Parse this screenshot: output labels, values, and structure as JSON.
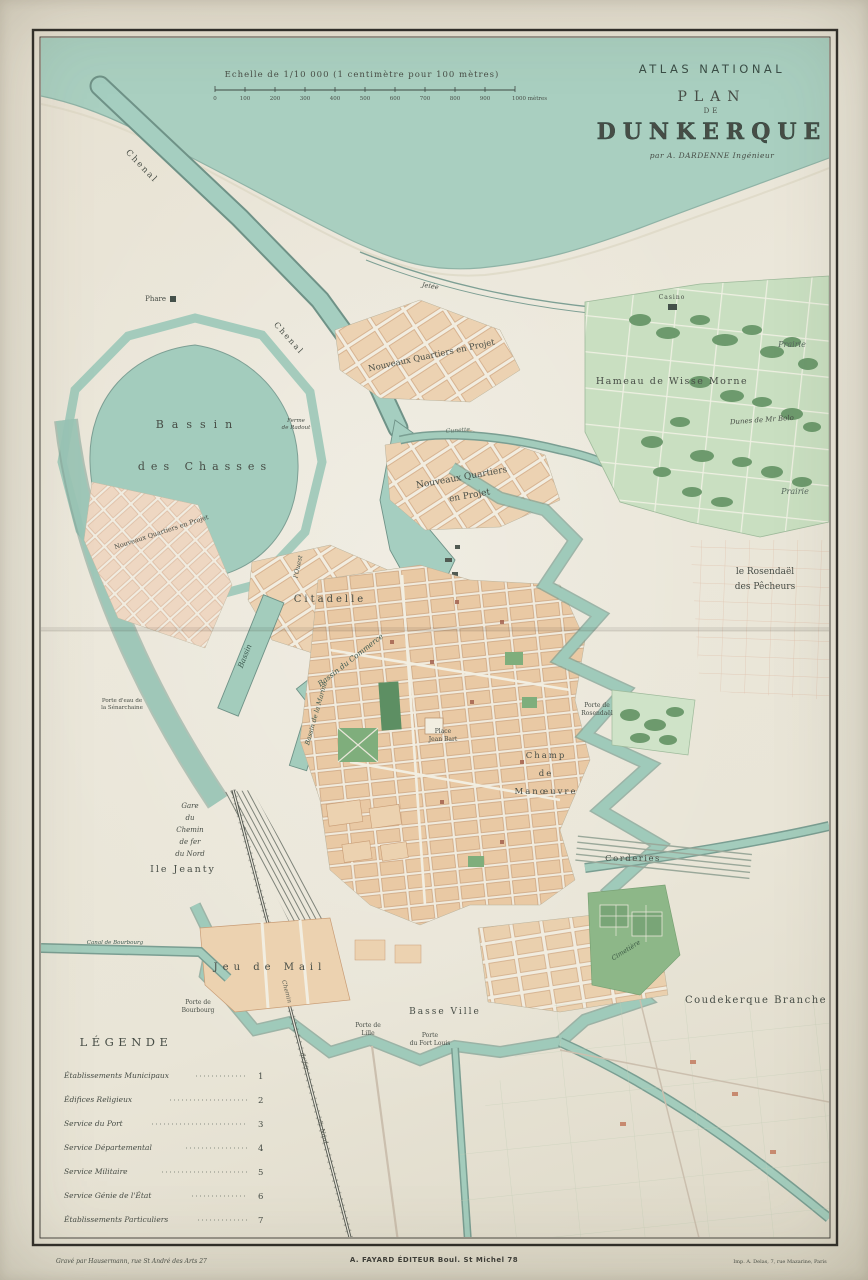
{
  "title": {
    "series": "ATLAS NATIONAL",
    "plan": "PLAN",
    "de": "DE",
    "city": "DUNKERQUE",
    "author": "par A. DARDENNE Ingénieur"
  },
  "scale": {
    "caption": "Echelle de 1/10 000 (1 centimètre pour 100 mètres)",
    "ticks": [
      "0",
      "100",
      "200",
      "300",
      "400",
      "500",
      "600",
      "700",
      "800",
      "900",
      "1000 mètres"
    ]
  },
  "legend": {
    "title": "LÉGENDE",
    "items": [
      {
        "label": "Établissements Municipaux",
        "num": "1"
      },
      {
        "label": "Édifices Religieux",
        "num": "2"
      },
      {
        "label": "Service du Port",
        "num": "3"
      },
      {
        "label": "Service Départemental",
        "num": "4"
      },
      {
        "label": "Service Militaire",
        "num": "5"
      },
      {
        "label": "Service Génie de l'État",
        "num": "6"
      },
      {
        "label": "Établissements Particuliers",
        "num": "7"
      }
    ]
  },
  "imprint": {
    "left": "Gravé par Hausermann, rue St André des Arts 27",
    "center": "A. FAYARD ÉDITEUR  Boul. St Michel 78",
    "right": "Imp. A. Delas, 7, rue Mazarine, Paris"
  },
  "labels": {
    "chenal_a": "Chenal",
    "chenal_b": "Chenal",
    "phare": "Phare",
    "jetee": "Jetée",
    "bassin1": "Bassin",
    "bassin2": "des Chasses",
    "ferme1": "Ferme",
    "ferme2": "de Radout",
    "nq1": "Nouveaux Quartiers en Projet",
    "nq2a": "Nouveaux Quartiers",
    "nq2b": "en Projet",
    "nq3": "Nouveaux Quartiers en Projet",
    "cunette": "Cunette",
    "hameau": "Hameau de Wisse Morne",
    "casino": "Casino",
    "prairie1": "Prairie",
    "prairie2": "Prairie",
    "dunes_prop": "Dunes de Mr Bolo",
    "rosendael1": "le Rosendaël",
    "rosendael2": "des Pêcheurs",
    "citadelle": "Citadelle",
    "bassin_commerce": "Bassin du Commerce",
    "bassin_ouest": "Bassin",
    "louest": "l'Ouest",
    "bassin_marine": "Bassin de la Marine",
    "porte_eau1": "Porte d'eau de",
    "porte_eau2": "la Sénarchaine",
    "place1": "Place",
    "place2": "Jean Bart",
    "champ1": "Champ",
    "champ2": "de",
    "champ3": "Manœuvre",
    "porte_ros1": "Porte de",
    "porte_ros2": "Rosendaël",
    "gare1": "Gare",
    "gare2": "du",
    "gare3": "Chemin",
    "gare4": "de fer",
    "gare5": "du Nord",
    "ile_jeanty": "Ile Jeanty",
    "jeu_de_mail": "Jeu de Mail",
    "porte_bourbourg1": "Porte de",
    "porte_bourbourg2": "Bourbourg",
    "basse_ville": "Basse Ville",
    "porte_lille1": "Porte de",
    "porte_lille2": "Lille",
    "porte_fl1": "Porte",
    "porte_fl2": "du Fort Louis",
    "corderies": "Corderies",
    "cimetiere": "Cimetière",
    "coudekerque": "Coudekerque Branche",
    "rail1": "Chemin",
    "rail2": "de fer",
    "rail3": "du Nord",
    "canal_bourbourg": "Canal de Bourbourg"
  },
  "colors": {
    "sea": "#a9cfc0",
    "water": "#a3ccbc",
    "water_edge": "#7a9e92",
    "blocks": "#eaceac",
    "park": "#7fae7c",
    "paper": "#eee9dc",
    "ink": "#474d46"
  }
}
